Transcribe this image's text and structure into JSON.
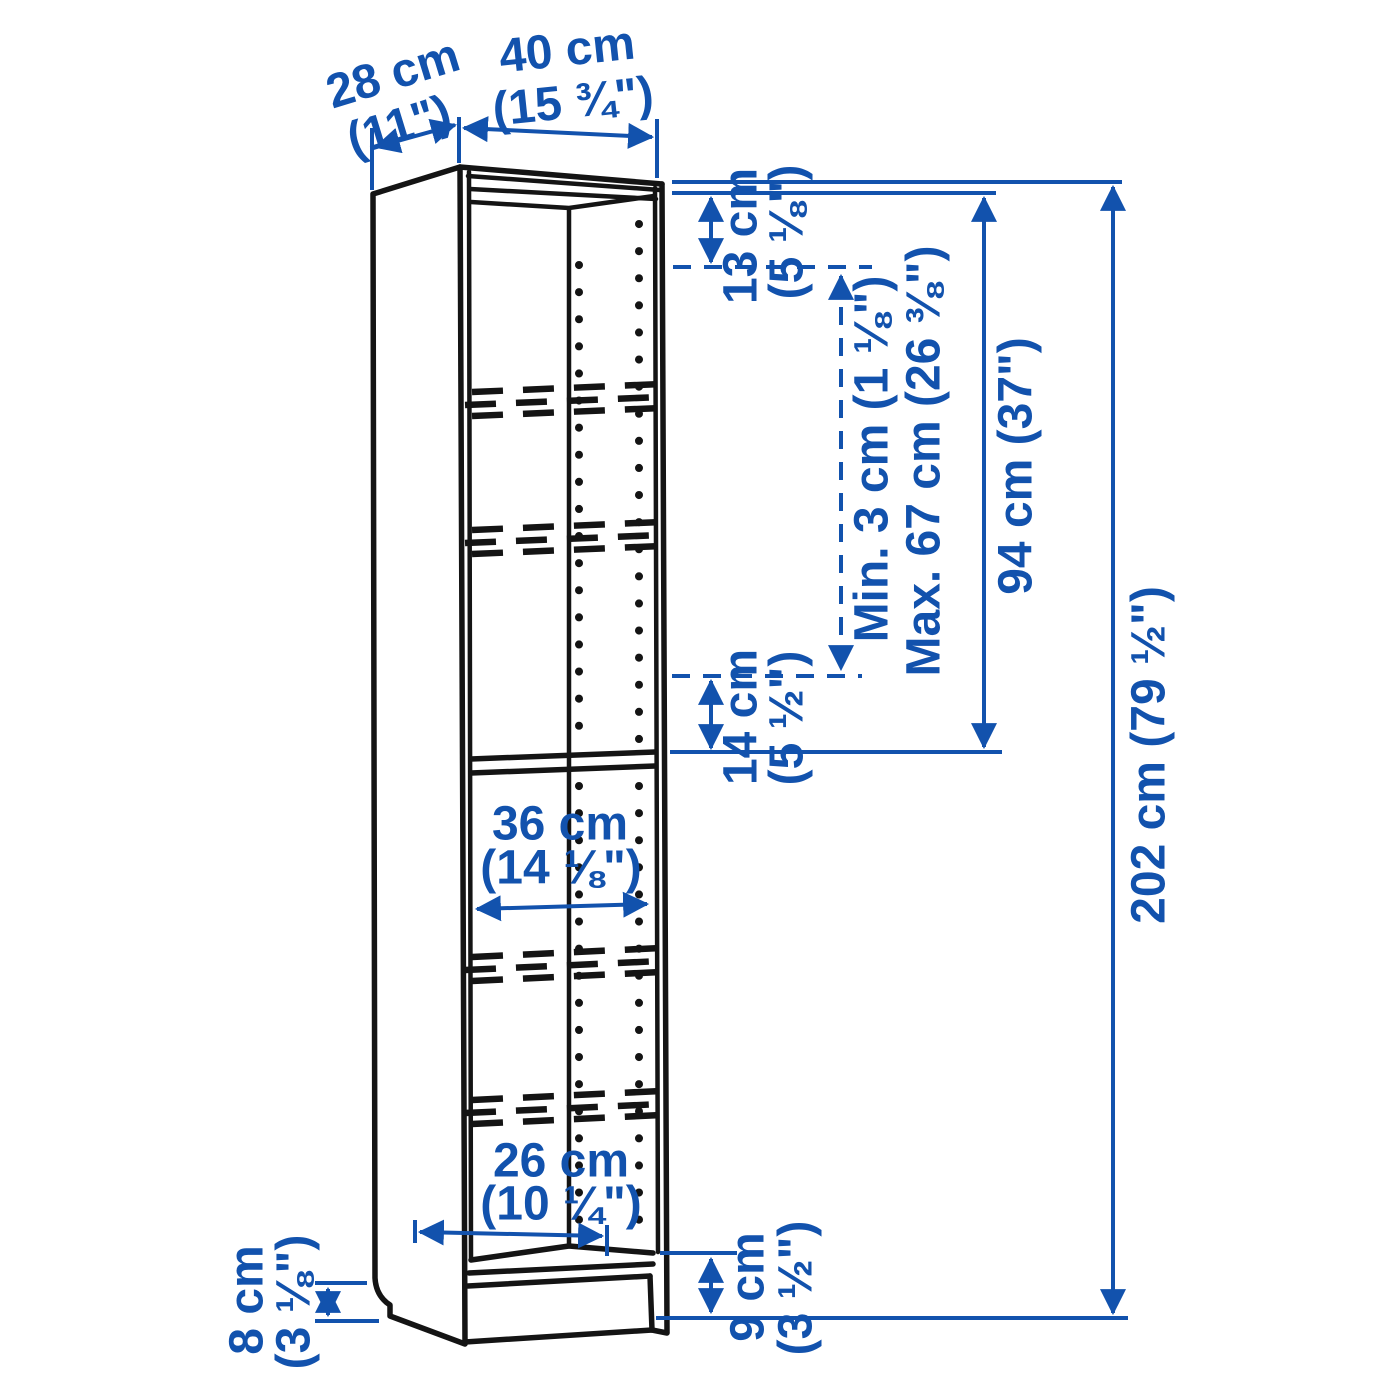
{
  "title": "Bookcase dimension diagram",
  "colors": {
    "accent": "#1252ad",
    "line": "#141414",
    "background": "#ffffff"
  },
  "labels": {
    "depth_cm": "28 cm",
    "depth_in": "(11\")",
    "width_cm": "40 cm",
    "width_in": "(15 ¾\")",
    "top_gap_cm": "13 cm",
    "top_gap_in": "(5 ⅛\")",
    "shelf_spacing_min": "Min. 3 cm (1 ⅛\")",
    "shelf_spacing_max": "Max. 67 cm (26 ⅜\")",
    "upper_section_height": "94 cm (37\")",
    "total_height": "202 cm (79 ½\")",
    "mid_gap_cm": "14 cm",
    "mid_gap_in": "(5 ½\")",
    "inner_width_cm": "36 cm",
    "inner_width_in": "(14 ⅛\")",
    "bottom_inner_cm": "26 cm",
    "bottom_inner_in": "(10 ¼\")",
    "plinth_side_cm": "8 cm",
    "plinth_side_in": "(3 ⅛\")",
    "plinth_front_cm": "9 cm",
    "plinth_front_in": "(3 ½\")"
  }
}
